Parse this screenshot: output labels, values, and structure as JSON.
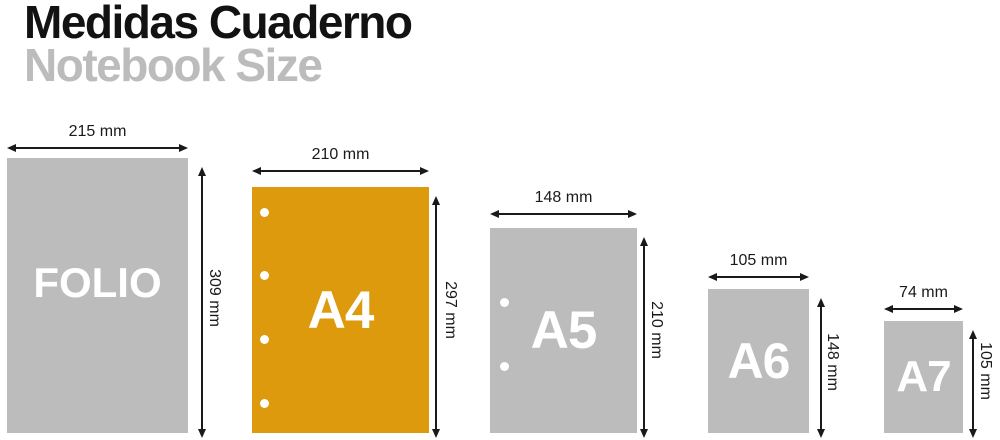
{
  "header": {
    "title": "Medidas Cuaderno",
    "subtitle": "Notebook Size"
  },
  "colors": {
    "sheet_gray": "#bcbcbc",
    "sheet_accent_orange": "#dc9a0c",
    "subtitle_gray": "#bcbcbc",
    "dimension_ink": "#1a1a1a",
    "sheet_label_white": "#ffffff"
  },
  "notebooks": [
    {
      "label": "FOLIO",
      "width_label": "215 mm",
      "height_label": "309 mm",
      "width_mm": 215,
      "height_mm": 309,
      "hole_count": 0,
      "highlighted": false
    },
    {
      "label": "A4",
      "width_label": "210 mm",
      "height_label": "297 mm",
      "width_mm": 210,
      "height_mm": 297,
      "hole_count": 4,
      "highlighted": true
    },
    {
      "label": "A5",
      "width_label": "148 mm",
      "height_label": "210 mm",
      "width_mm": 148,
      "height_mm": 210,
      "hole_count": 2,
      "highlighted": false
    },
    {
      "label": "A6",
      "width_label": "105 mm",
      "height_label": "148 mm",
      "width_mm": 105,
      "height_mm": 148,
      "hole_count": 0,
      "highlighted": false
    },
    {
      "label": "A7",
      "width_label": "74 mm",
      "height_label": "105 mm",
      "width_mm": 74,
      "height_mm": 105,
      "hole_count": 0,
      "highlighted": false
    }
  ]
}
